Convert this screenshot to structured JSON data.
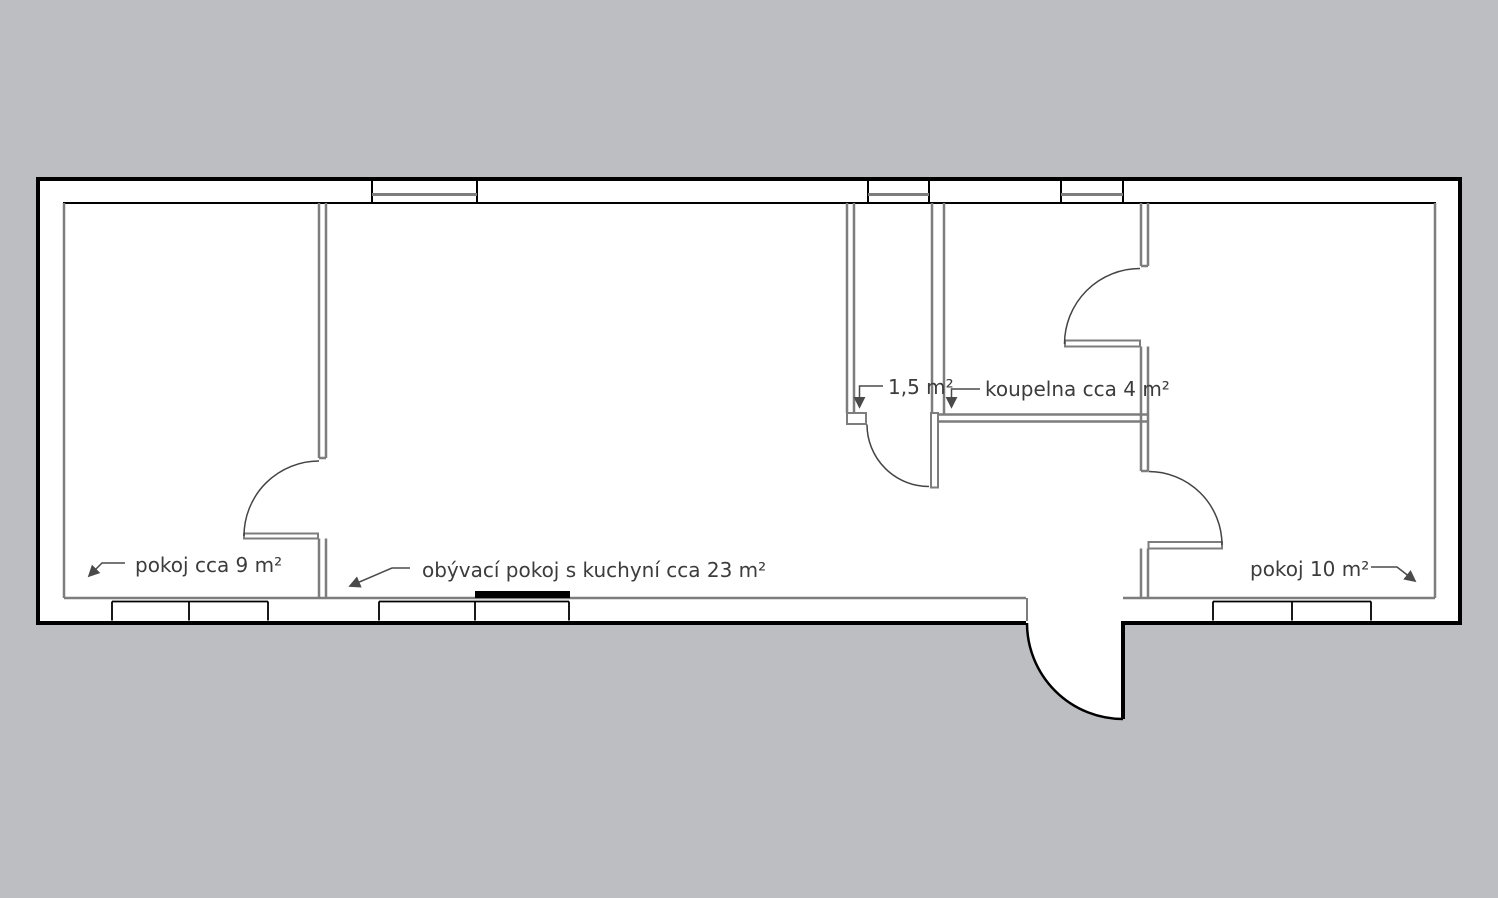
{
  "plan": {
    "labels": {
      "room_small_left": "pokoj cca 9 m²",
      "living_room": "obývací pokoj s kuchyní cca 23 m²",
      "wc": "1,5 m²",
      "bathroom": "koupelna cca 4 m²",
      "room_right": "pokoj 10 m²"
    },
    "colors": {
      "background": "#bdbec2",
      "outer_wall_outline": "#000000",
      "interior_lines": "#7d7d7d",
      "door_arc": "#444444",
      "label_text": "#3c3c3c"
    }
  }
}
